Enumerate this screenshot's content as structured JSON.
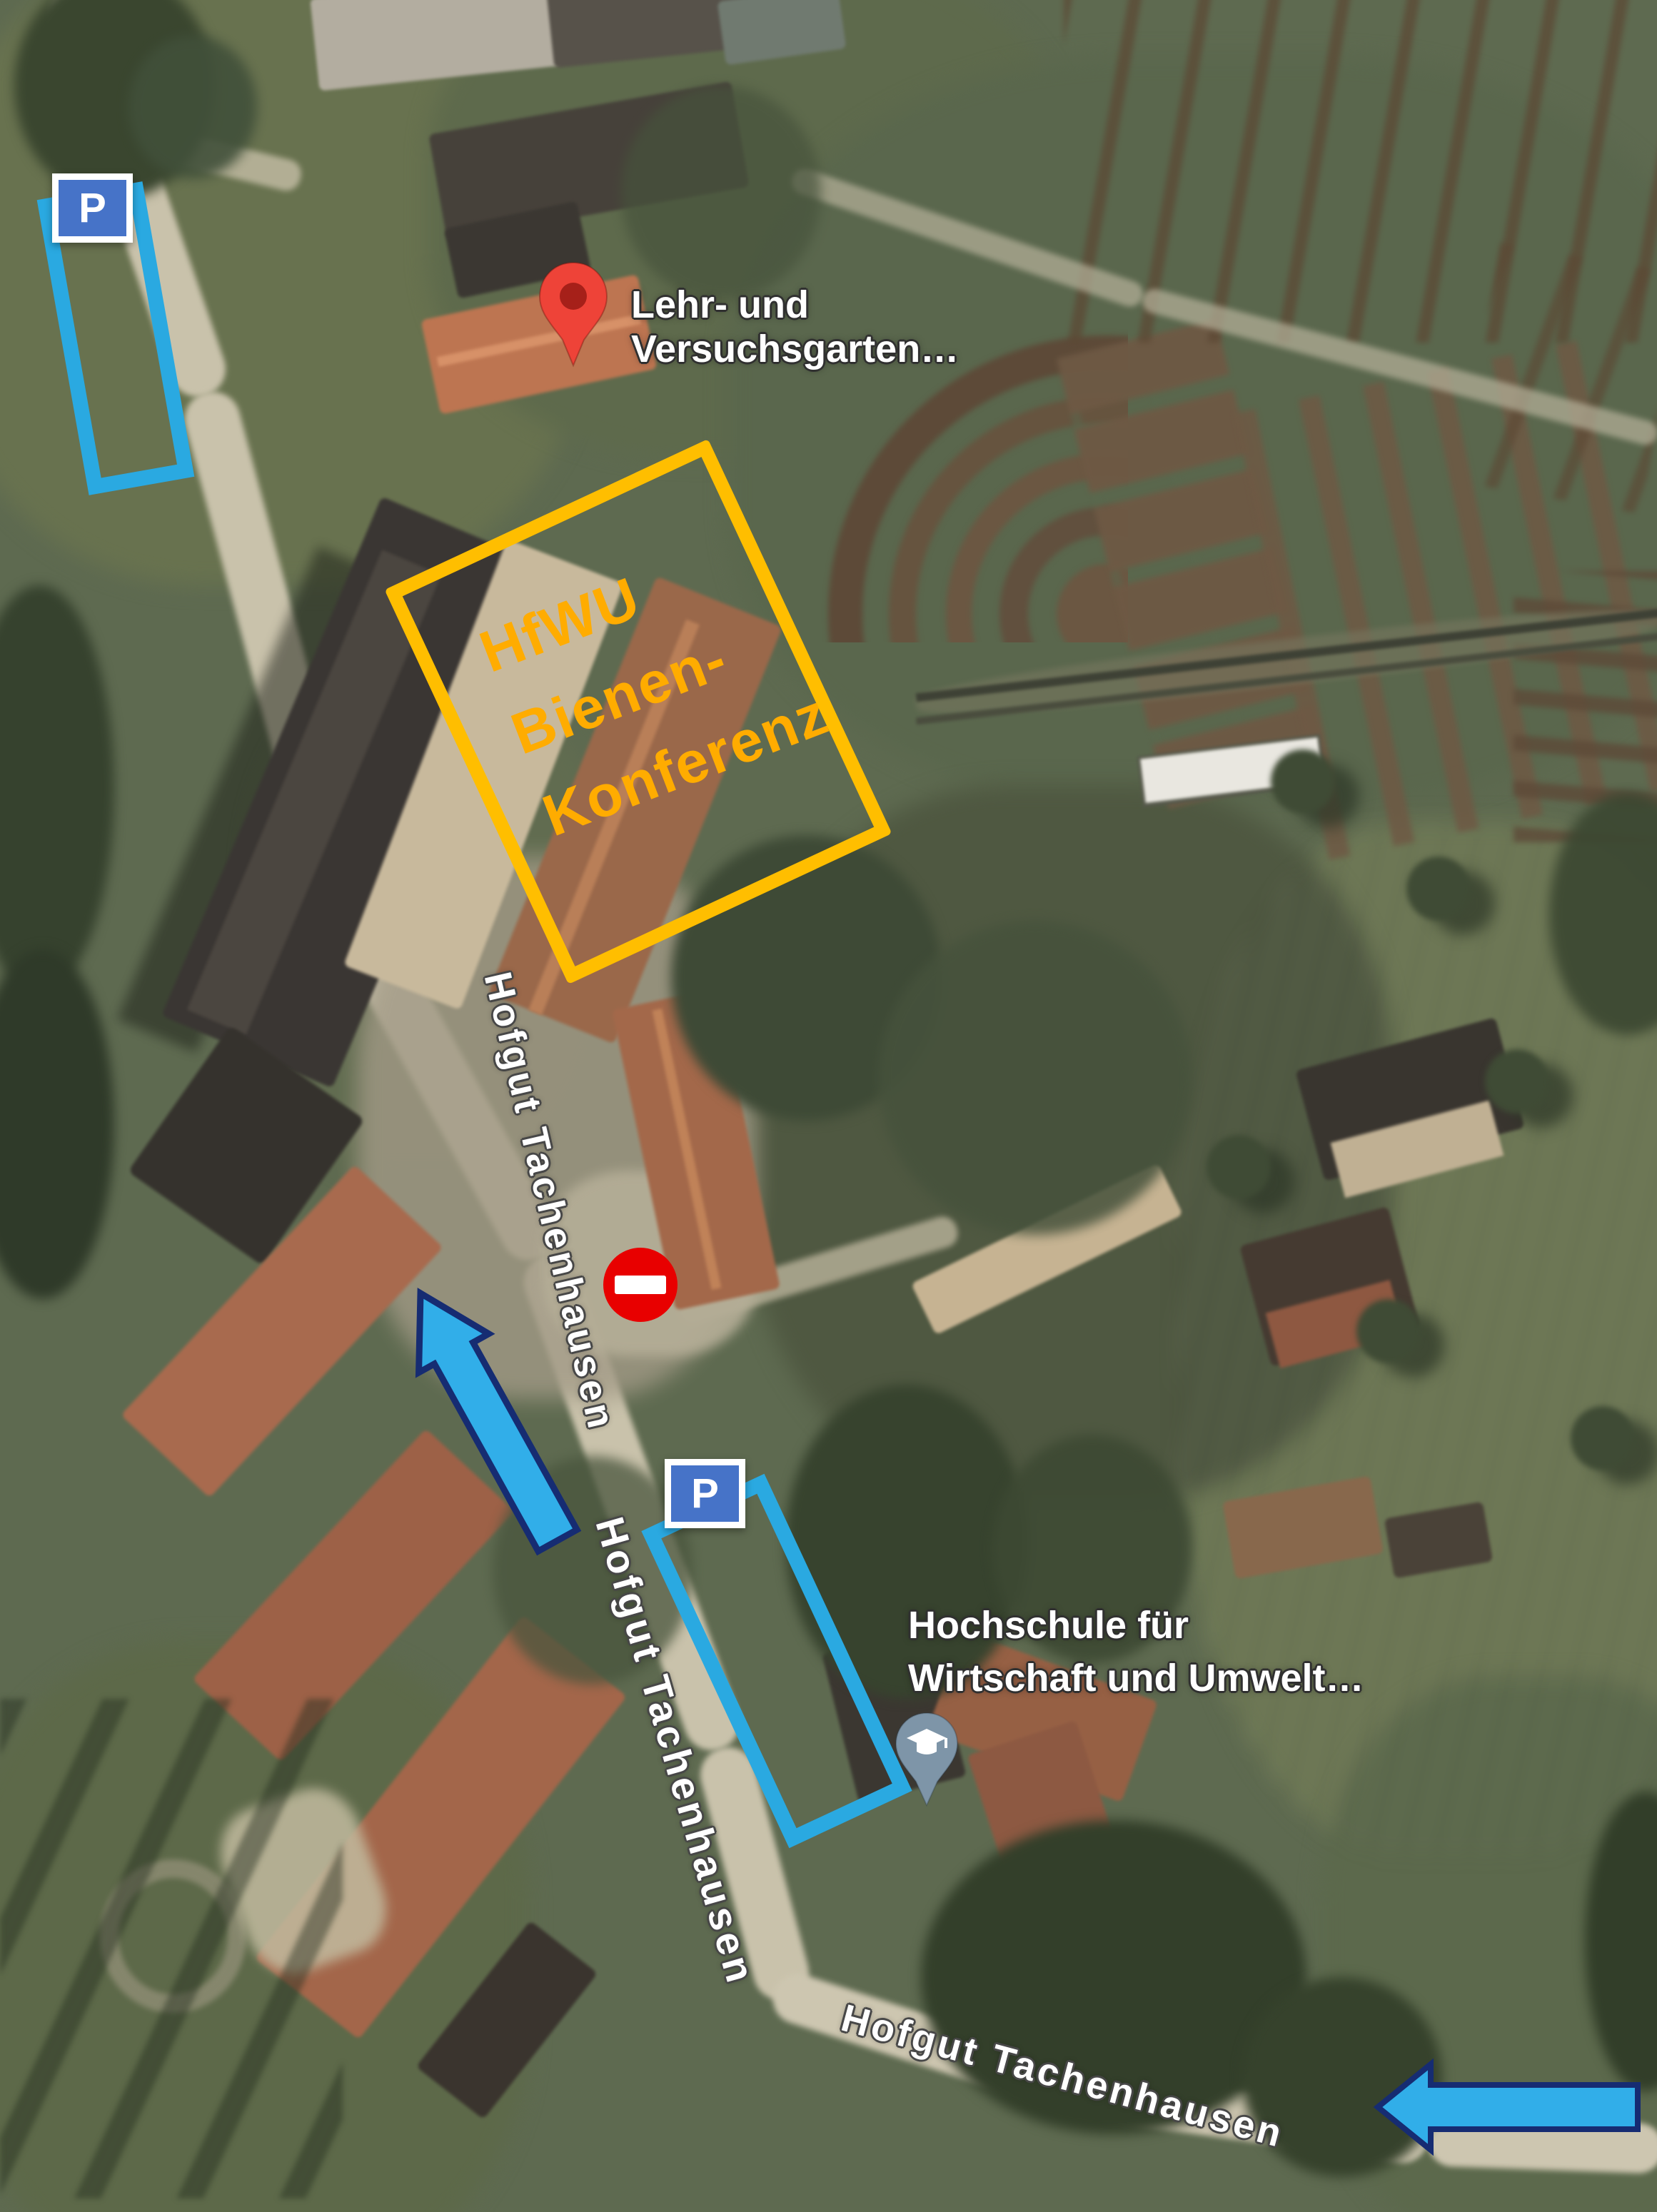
{
  "street_labels": [
    "Hofgut Tachenhausen",
    "Hofgut Tachenhausen",
    "Hofgut Tachenhausen"
  ],
  "pois": [
    {
      "id": "lehr-und-versuchsgarten",
      "title": "Lehr- und Versuchsgarten…",
      "lines": [
        "Lehr- und",
        "Versuchsgarten…"
      ]
    },
    {
      "id": "hochschule-wirtschaft-umwelt",
      "title": "Hochschule für Wirtschaft und Umwelt…",
      "lines": [
        "Hochschule für",
        "Wirtschaft und Umwelt…"
      ]
    }
  ],
  "overlays": {
    "event_box": {
      "lines": [
        "HfWU",
        "Bienen-",
        "Konferenz"
      ],
      "border_color": "#FFBE00",
      "text_color": "#FFAC00"
    },
    "parking_signs": [
      {
        "label": "P"
      },
      {
        "label": "P"
      }
    ],
    "parking_outline_color": "#2AA9E1",
    "arrows": {
      "fill": "#31AEE9",
      "outline": "#162C72",
      "directions": [
        "up-left",
        "left"
      ]
    },
    "no_entry_color": "#E80000",
    "pin_colors": {
      "poi_red": "#EE4338",
      "education_slate": "#7E95A8"
    }
  }
}
